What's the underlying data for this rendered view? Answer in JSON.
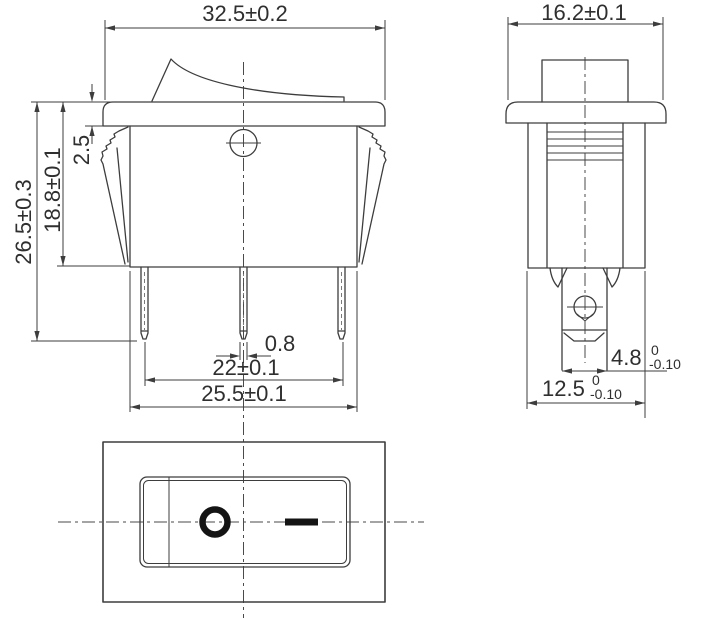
{
  "document": {
    "kind": "technical-drawing",
    "subject": "rocker switch 3-view dimension drawing",
    "units": "mm"
  },
  "colors": {
    "line": "#3d3d3d",
    "text": "#2f2f2f",
    "symbol": "#141414",
    "background": "#ffffff"
  },
  "views": {
    "front": {
      "label": "front view",
      "dims": {
        "width": "32.5±0.2",
        "overall_height": "26.5±0.3",
        "body_height": "18.8±0.1",
        "flange_thickness": "2.5",
        "terminal_thickness": "0.8",
        "terminal_span": "22±0.1",
        "base_width": "25.5±0.1"
      }
    },
    "side": {
      "label": "side view",
      "dims": {
        "width": "16.2±0.1",
        "terminal_width": {
          "value": "4.8",
          "tol_upper": "0",
          "tol_lower": "-0.10"
        },
        "base_depth": {
          "value": "12.5",
          "tol_upper": "0",
          "tol_lower": "-0.10"
        }
      }
    },
    "bottom": {
      "label": "face view",
      "markings": {
        "off": "O",
        "on": "—"
      }
    }
  }
}
